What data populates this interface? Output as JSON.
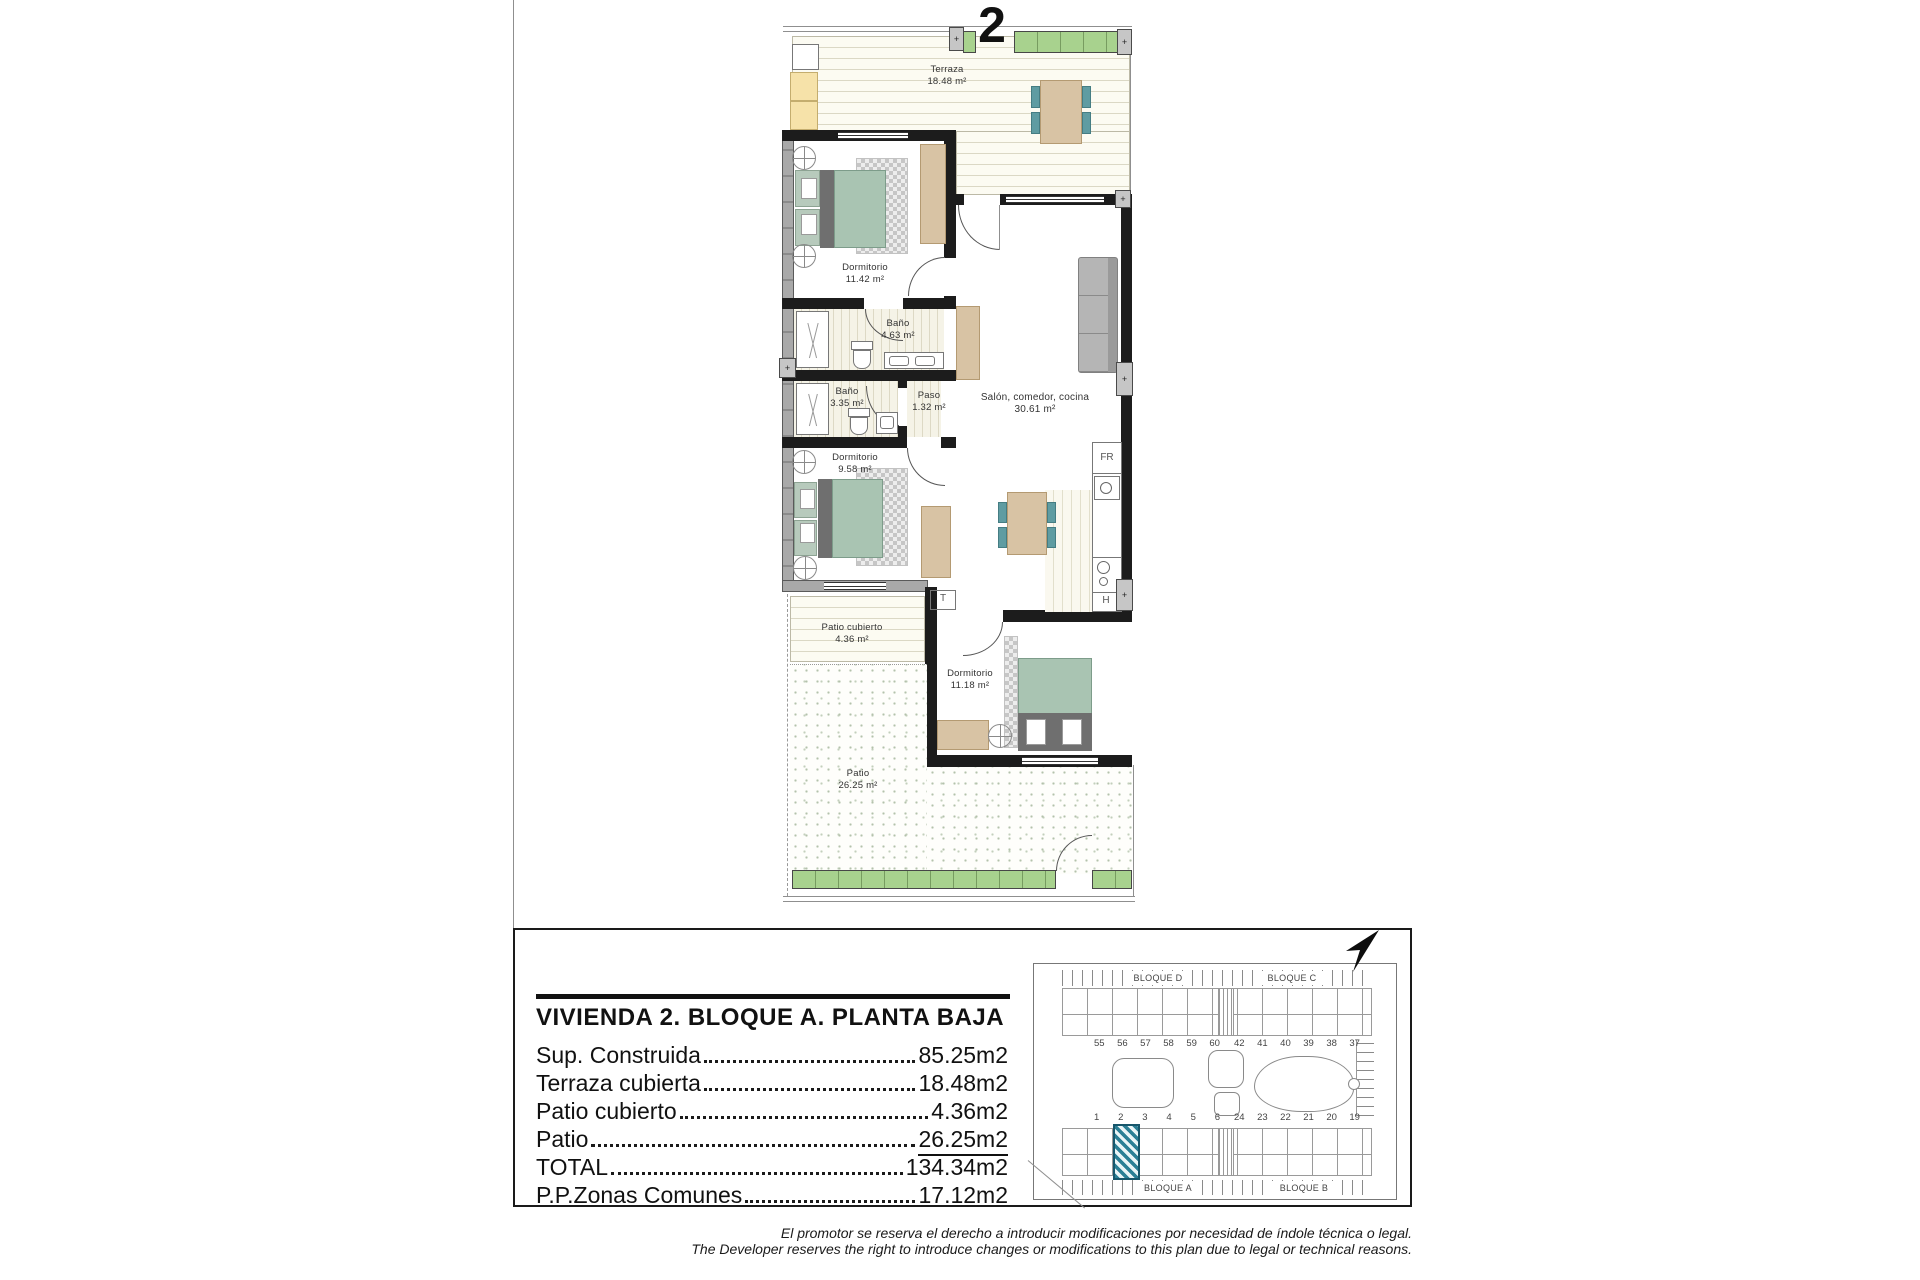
{
  "plan": {
    "unit_number": "2",
    "wall_marker": "+",
    "rooms": {
      "terraza": {
        "name": "Terraza",
        "area": "18.48 m²"
      },
      "dormitorio1": {
        "name": "Dormitorio",
        "area": "11.42 m²"
      },
      "bano1": {
        "name": "Baño",
        "area": "4.63 m²"
      },
      "bano2": {
        "name": "Baño",
        "area": "3.35 m²"
      },
      "paso": {
        "name": "Paso",
        "area": "1.32 m²"
      },
      "dormitorio2": {
        "name": "Dormitorio",
        "area": "9.58 m²"
      },
      "salon": {
        "name": "Salón, comedor, cocina",
        "area": "30.61 m²"
      },
      "patio_cubierto": {
        "name": "Patio cubierto",
        "area": "4.36 m²"
      },
      "dormitorio3": {
        "name": "Dormitorio",
        "area": "11.18 m²"
      },
      "patio": {
        "name": "Patio",
        "area": "26.25 m²"
      }
    },
    "labels": {
      "fridge": "FR",
      "hob": "H",
      "tank": "T"
    }
  },
  "info_panel": {
    "title": "VIVIENDA 2. BLOQUE A. PLANTA BAJA",
    "rows": [
      {
        "label": "Sup. Construida",
        "value": "85.25m2"
      },
      {
        "label": "Terraza cubierta",
        "value": "18.48m2"
      },
      {
        "label": "Patio cubierto",
        "value": "4.36m2"
      },
      {
        "label": "Patio",
        "value": "26.25m2"
      },
      {
        "label": "TOTAL",
        "value": "134.34m2"
      },
      {
        "label": "P.P.Zonas Comunes",
        "value": "17.12m2"
      }
    ]
  },
  "site_plan": {
    "blocks": {
      "top_left": "BLOQUE D",
      "top_right": "BLOQUE C",
      "bottom_left": "BLOQUE A",
      "bottom_right": "BLOQUE B"
    },
    "units_top_left": [
      "55",
      "56",
      "57",
      "58",
      "59",
      "60"
    ],
    "units_top_right": [
      "42",
      "41",
      "40",
      "39",
      "38",
      "37"
    ],
    "units_bottom_left": [
      "1",
      "2",
      "3",
      "4",
      "5",
      "6"
    ],
    "units_bottom_right": [
      "24",
      "23",
      "22",
      "21",
      "20",
      "19"
    ],
    "highlighted_unit": "2"
  },
  "disclaimer": {
    "line_es": "El promotor se reserva el derecho a introducir modificaciones por necesidad de índole técnica o legal.",
    "line_en": "The Developer reserves the right to introduce changes or modifications to this plan due to legal or technical reasons."
  }
}
